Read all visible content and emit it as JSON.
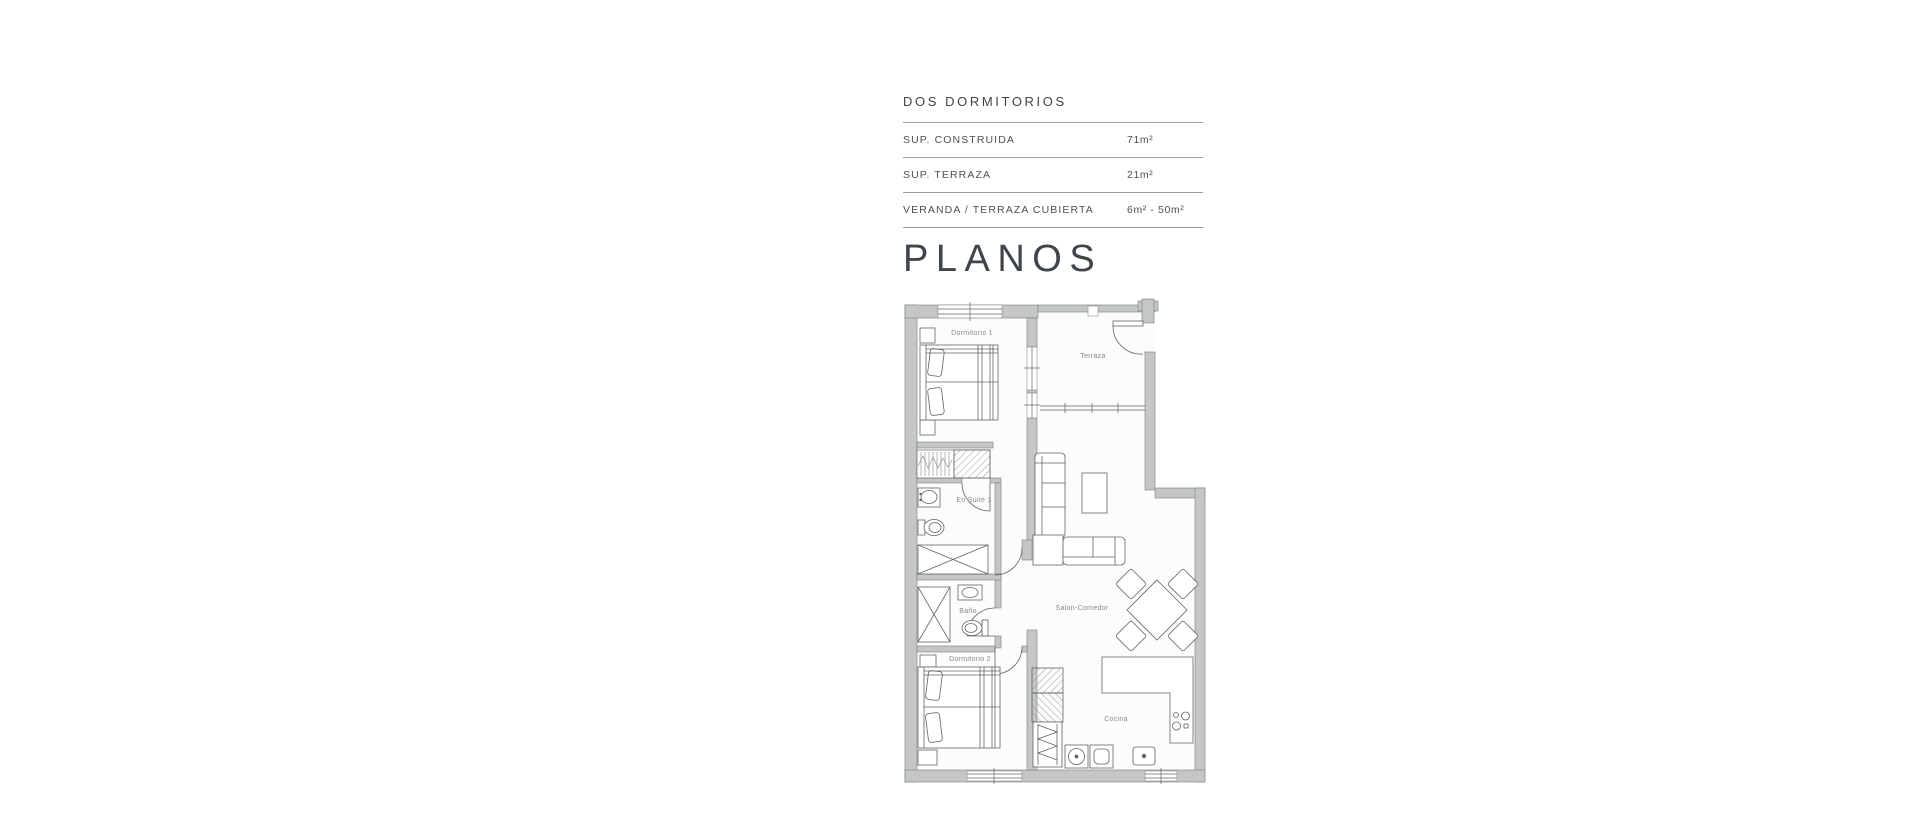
{
  "title": "DOS DORMITORIOS",
  "specs": {
    "rows": [
      {
        "label": "SUP.  CONSTRUIDA",
        "value": "71m²"
      },
      {
        "label": "SUP. TERRAZA",
        "value": "21m²"
      },
      {
        "label": "VERANDA / TERRAZA CUBIERTA",
        "value": "6m² - 50m²"
      }
    ]
  },
  "section_heading": "PLANOS",
  "floorplan": {
    "rooms": {
      "dormitorio1": "Dormitorio 1",
      "terraza": "Terraza",
      "ensuite": "En Suite 1",
      "bano": "Baño",
      "dormitorio2": "Dormitorio 2",
      "salon": "Salon-Comedor",
      "cocina": "Cocina"
    },
    "colors": {
      "wall": "#c5c7c7",
      "wall_edge": "#7a7e80",
      "line": "#5f6468",
      "hatch": "#989c9e",
      "label": "#85898b"
    }
  },
  "colors": {
    "heading": "#3f4549",
    "body_text": "#4b5155",
    "rule": "#9b9fa1",
    "background": "#ffffff"
  }
}
